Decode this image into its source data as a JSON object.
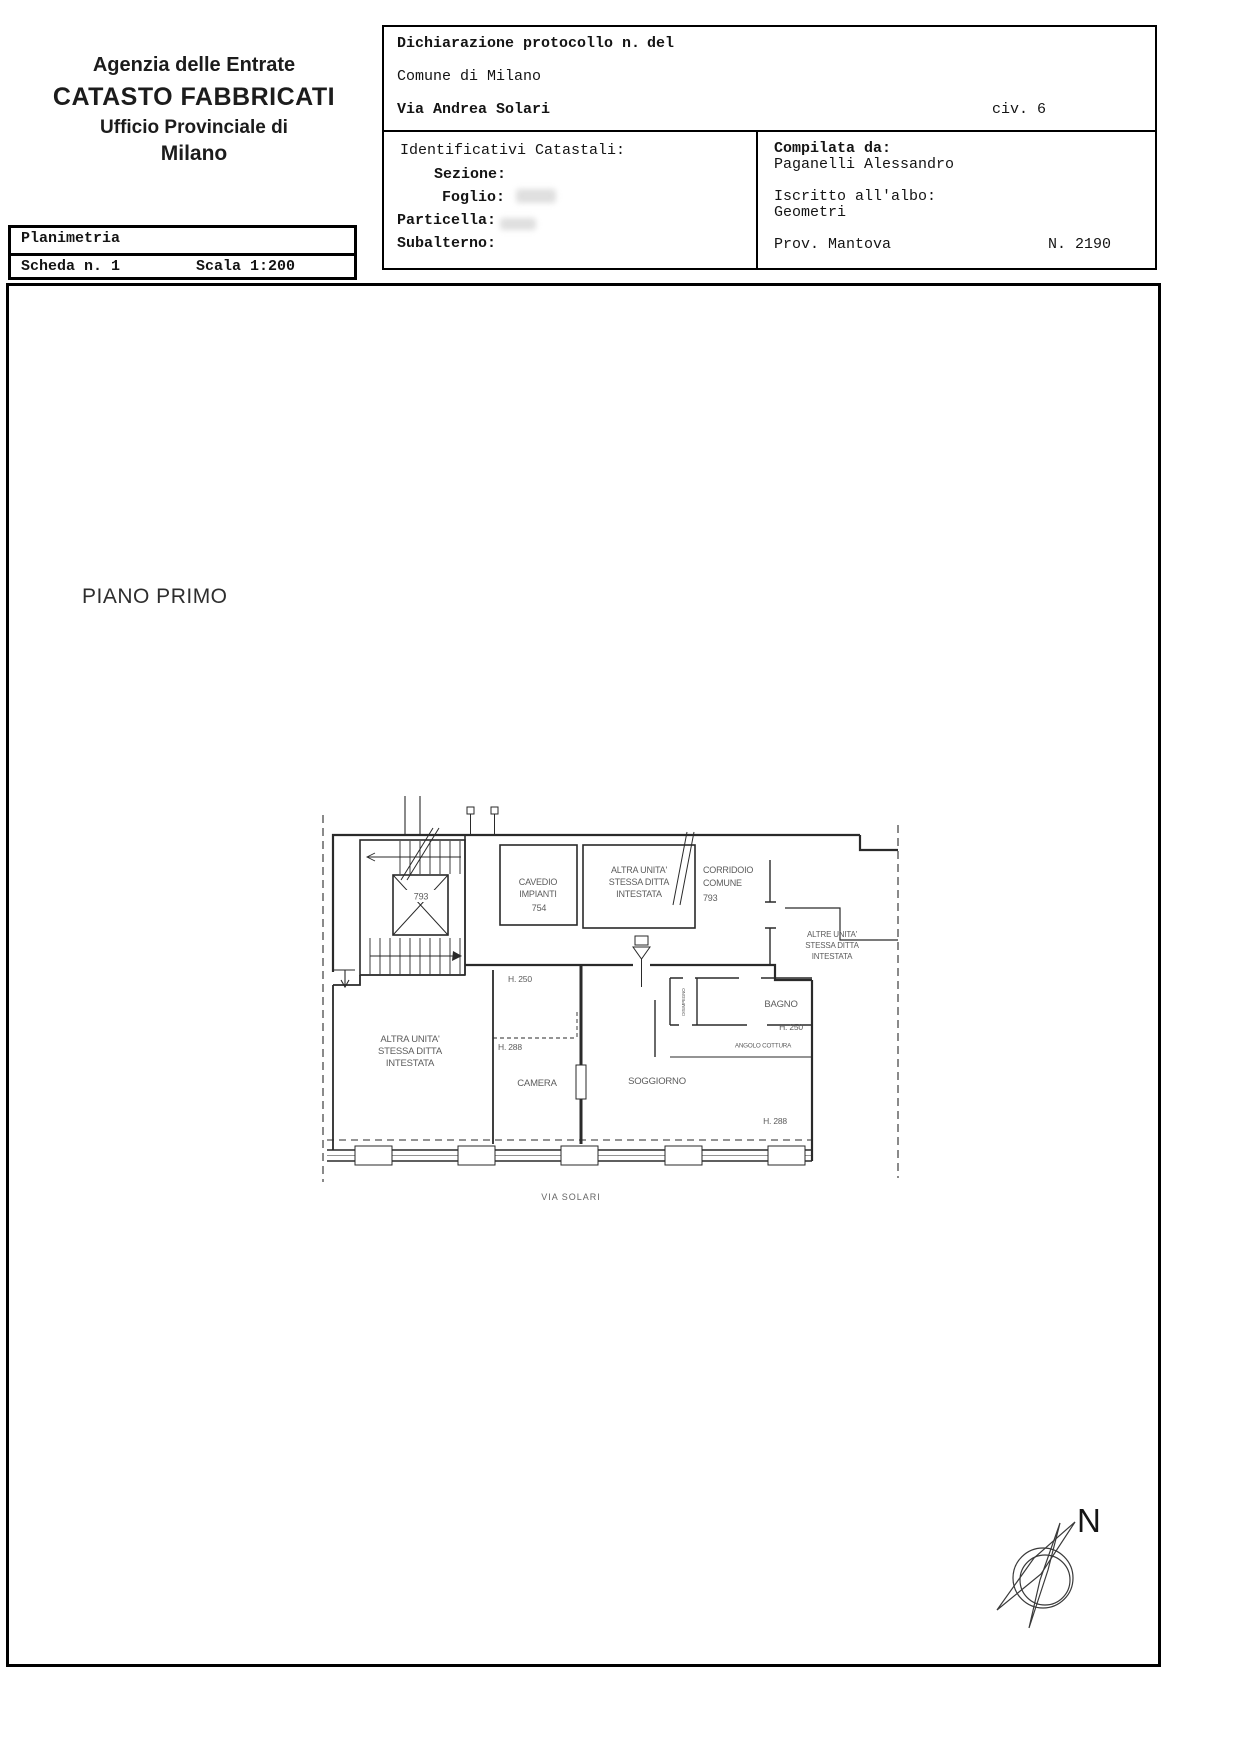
{
  "agency": {
    "line1": "Agenzia delle Entrate",
    "line2": "CATASTO FABBRICATI",
    "line3": "Ufficio Provinciale di",
    "line4": "Milano"
  },
  "planimetria": {
    "title": "Planimetria",
    "scheda": "Scheda n. 1",
    "scala": "Scala 1:200"
  },
  "declaration": {
    "protocol": "Dichiarazione protocollo n.",
    "del": "del",
    "comune": "Comune di Milano",
    "street": "Via Andrea Solari",
    "civic": "civ. 6"
  },
  "identifiers": {
    "title": "Identificativi Catastali:",
    "sezione": "Sezione:",
    "foglio": "Foglio:",
    "particella": "Particella:",
    "subalterno": "Subalterno:"
  },
  "compiler": {
    "label": "Compilata da:",
    "name": "Paganelli Alessandro",
    "albo_label": "Iscritto all'albo:",
    "albo": "Geometri",
    "prov": "Prov. Mantova",
    "num": "N. 2190"
  },
  "floor_title": "PIANO PRIMO",
  "plan": {
    "altra_unita": [
      "ALTRA UNITA'",
      "STESSA DITTA",
      "INTESTATA"
    ],
    "altre_unita": [
      "ALTRE UNITA'",
      "STESSA DITTA",
      "INTESTATA"
    ],
    "cavedio": [
      "CAVEDIO",
      "IMPIANTI",
      "754"
    ],
    "corridoio": [
      "CORRIDOIO",
      "COMUNE",
      "793"
    ],
    "vano_scala": "793",
    "h250": "H. 250",
    "h288": "H. 288",
    "bagno": "BAGNO",
    "angolo_cottura": "ANGOLO COTTURA",
    "camera": "CAMERA",
    "soggiorno": "SOGGIORNO",
    "disimpegno": "DISIMPEGNO"
  },
  "street_label": "VIA SOLARI",
  "compass": {
    "north": "N"
  }
}
